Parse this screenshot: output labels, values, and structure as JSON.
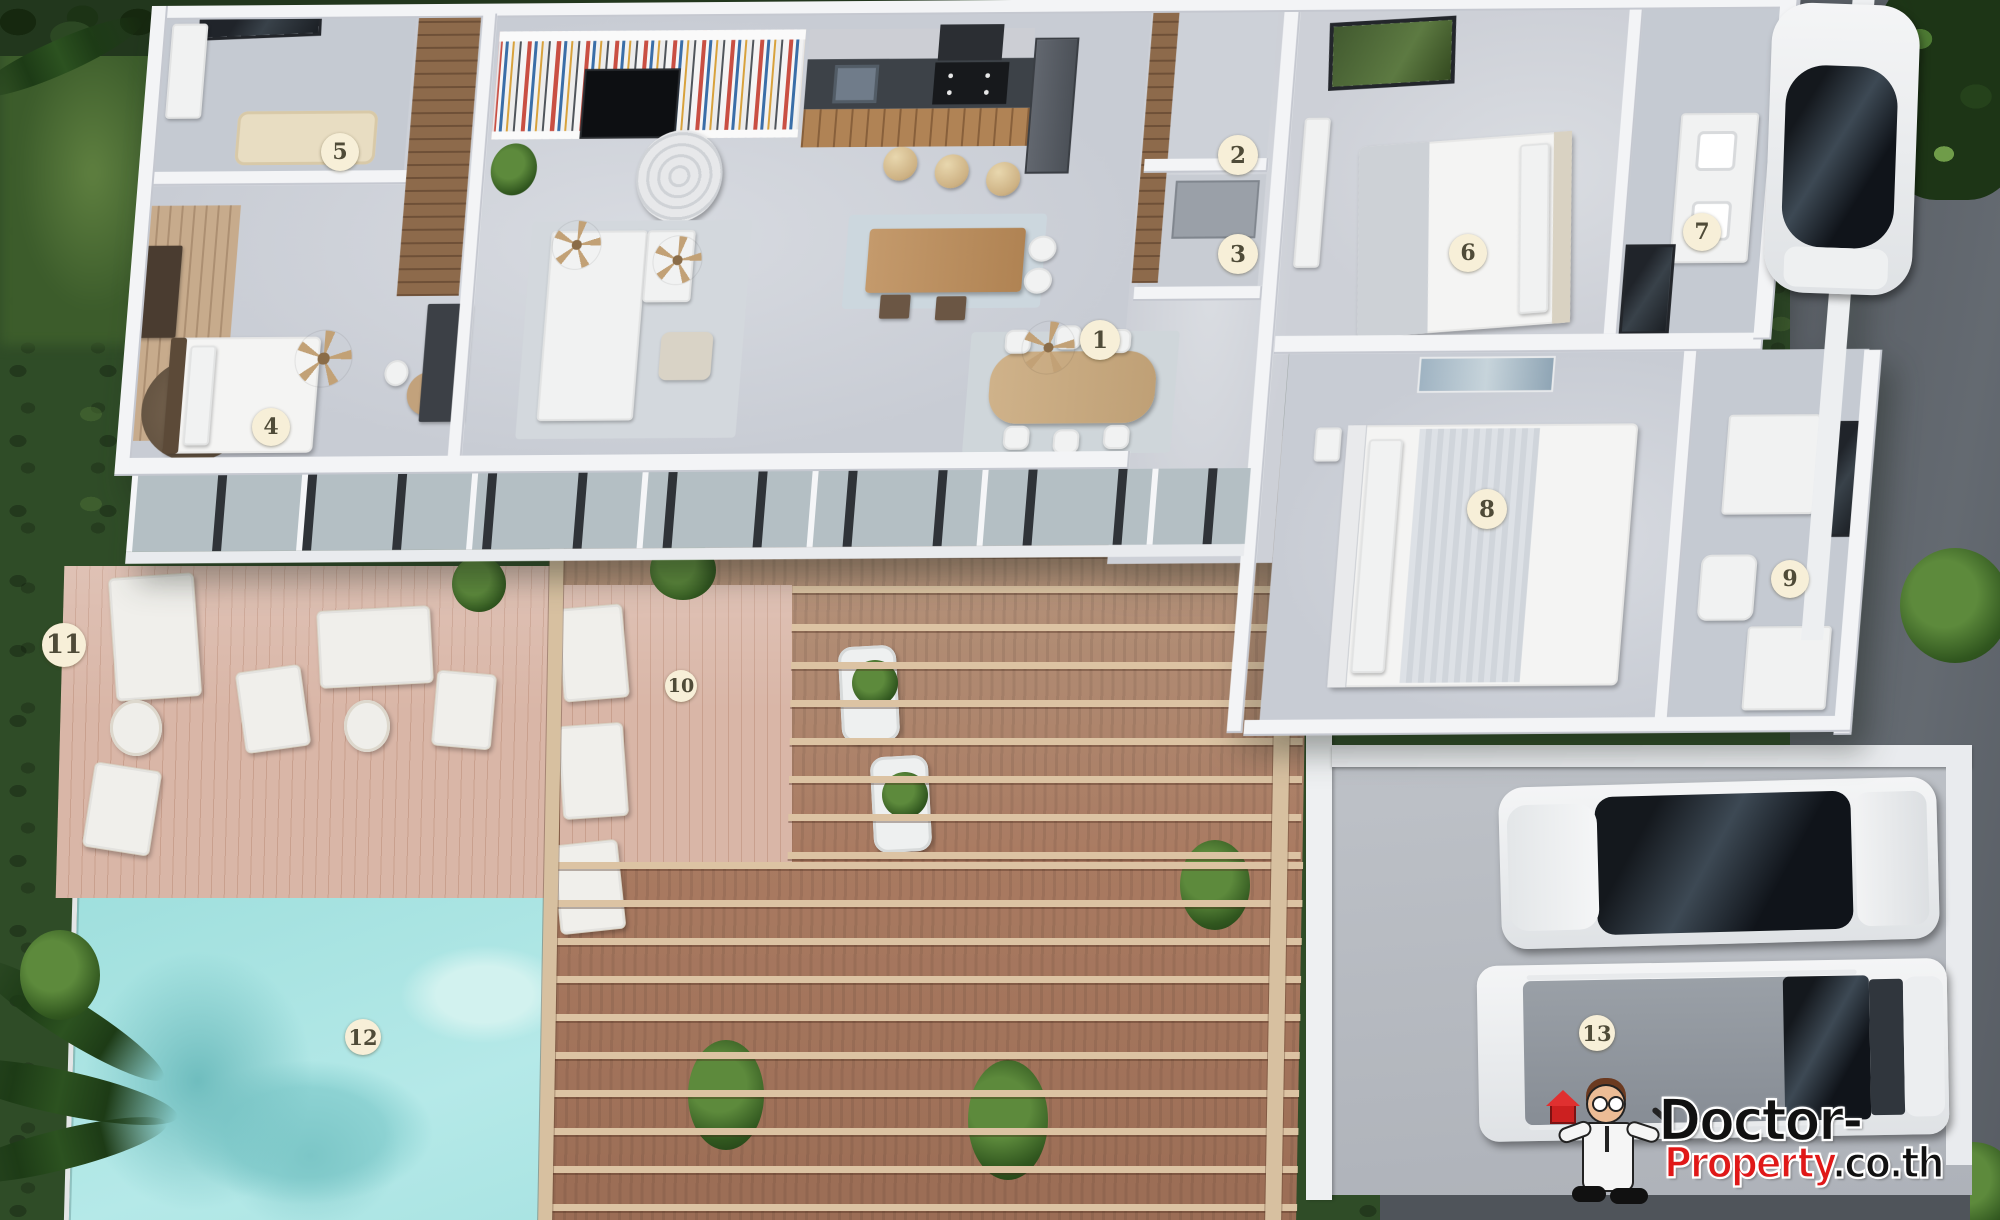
{
  "scene": {
    "type": "3d-floor-plan-top-view",
    "style": "villa with pool, deck, pergola and parking"
  },
  "markers": [
    {
      "label": "1",
      "x": 1100,
      "y": 340,
      "d": 40
    },
    {
      "label": "2",
      "x": 1238,
      "y": 155,
      "d": 40
    },
    {
      "label": "3",
      "x": 1238,
      "y": 254,
      "d": 40
    },
    {
      "label": "4",
      "x": 271,
      "y": 427,
      "d": 38
    },
    {
      "label": "5",
      "x": 340,
      "y": 152,
      "d": 38
    },
    {
      "label": "6",
      "x": 1468,
      "y": 253,
      "d": 38
    },
    {
      "label": "7",
      "x": 1702,
      "y": 232,
      "d": 38
    },
    {
      "label": "8",
      "x": 1487,
      "y": 509,
      "d": 40
    },
    {
      "label": "9",
      "x": 1790,
      "y": 579,
      "d": 38
    },
    {
      "label": "10",
      "x": 681,
      "y": 686,
      "d": 32
    },
    {
      "label": "11",
      "x": 64,
      "y": 645,
      "d": 44
    },
    {
      "label": "12",
      "x": 363,
      "y": 1037,
      "d": 36
    },
    {
      "label": "13",
      "x": 1597,
      "y": 1033,
      "d": 36
    }
  ],
  "watermark": {
    "brand_black": "Doctor-",
    "brand_red": "Property",
    "brand_suffix": ".co.th"
  },
  "colors": {
    "marker_bg": "#f7efd8",
    "marker_text": "#4f4b38",
    "pool_water": "#a8e2e2",
    "grass": "#2f4c27",
    "road": "#5b6066",
    "deck_wood": "#d9b6a7",
    "pergola_beam": "#dcc3a3",
    "brand_red": "#e01818"
  }
}
